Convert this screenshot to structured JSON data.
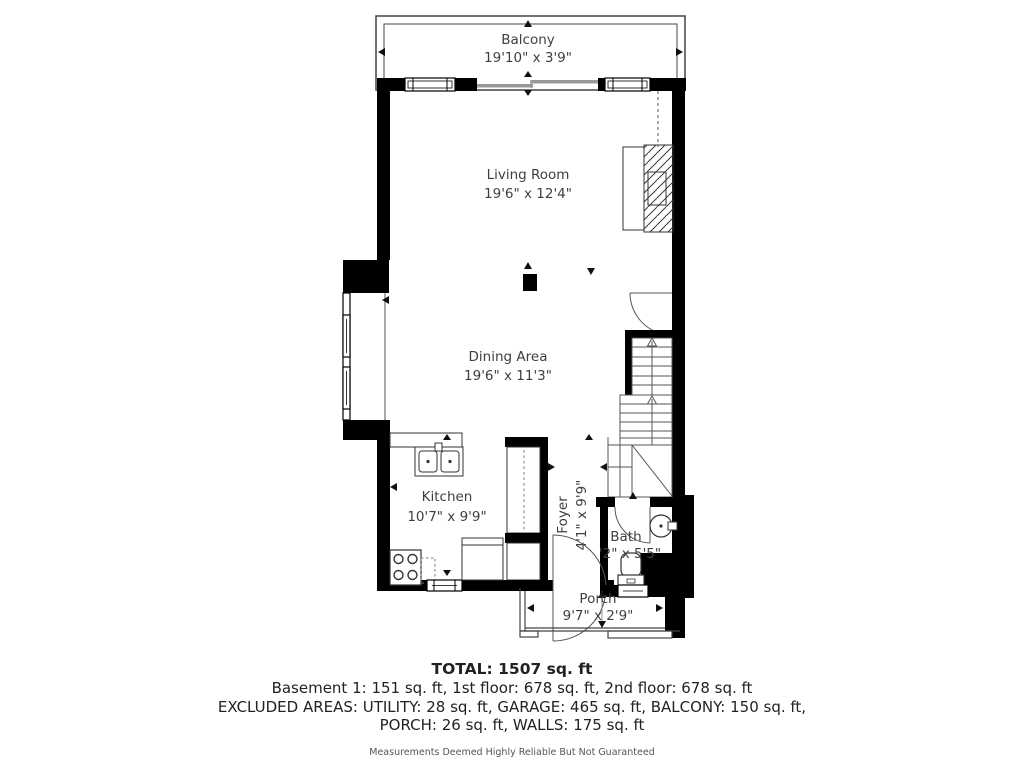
{
  "plan": {
    "rooms": {
      "balcony": {
        "label": "Balcony",
        "dims": "19'10\" x 3'9\""
      },
      "living": {
        "label": "Living Room",
        "dims": "19'6\" x 12'4\""
      },
      "dining": {
        "label": "Dining Area",
        "dims": "19'6\" x 11'3\""
      },
      "kitchen": {
        "label": "Kitchen",
        "dims": "10'7\" x 9'9\""
      },
      "foyer": {
        "label": "Foyer",
        "dims": "4'1\" x 9'9\""
      },
      "bath": {
        "label": "Bath",
        "dims": "'2\" x 5'5\""
      },
      "porch": {
        "label": "Porch",
        "dims": "9'7\" x 2'9\""
      }
    },
    "colors": {
      "wall": "#000000",
      "thin_line": "#4a4a4a",
      "slider": "#999999",
      "label_text": "#3f3f3f"
    }
  },
  "footer": {
    "total": "TOTAL: 1507 sq. ft",
    "line1": "Basement 1: 151 sq. ft, 1st floor: 678 sq. ft, 2nd floor: 678 sq. ft",
    "line2": "EXCLUDED AREAS: UTILITY: 28 sq. ft, GARAGE: 465 sq. ft, BALCONY: 150 sq. ft,",
    "line3": "PORCH: 26 sq. ft, WALLS: 175 sq. ft",
    "disclaimer": "Measurements Deemed Highly Reliable But Not Guaranteed"
  }
}
